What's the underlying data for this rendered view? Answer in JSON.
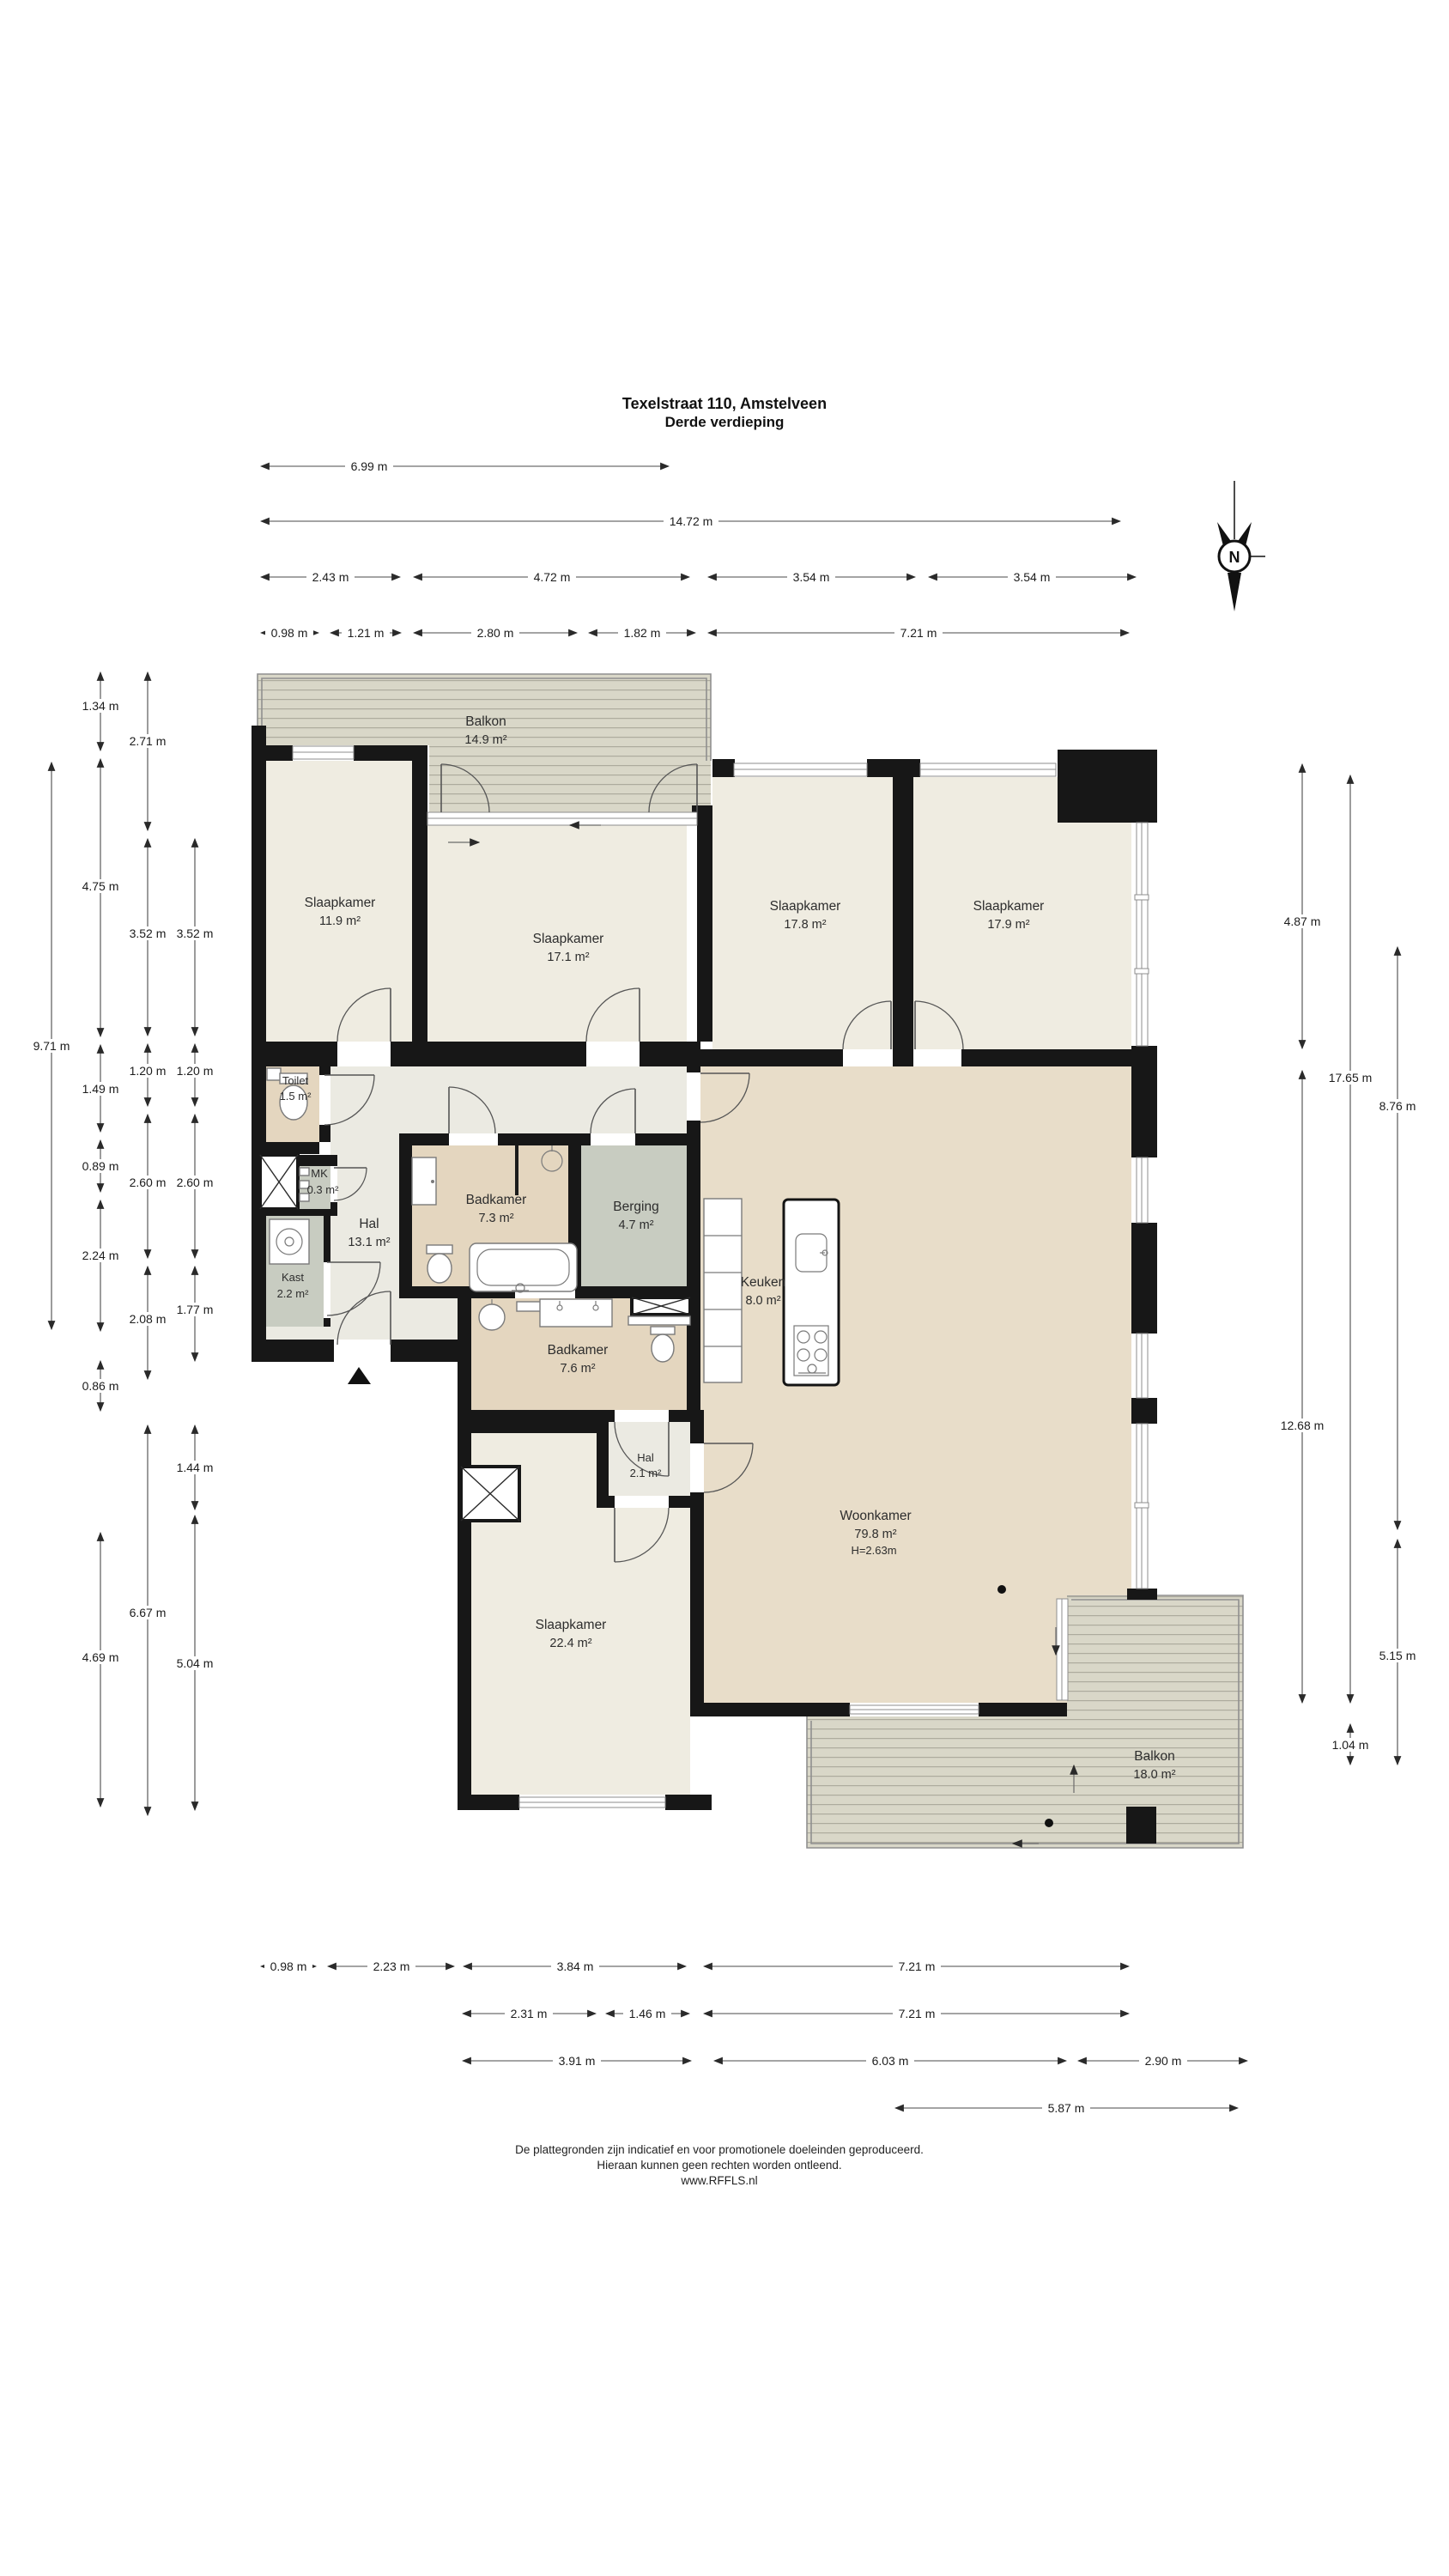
{
  "header": {
    "line1": "Texelstraat 110, Amstelveen",
    "line2": "Derde verdieping"
  },
  "compass": {
    "label": "N"
  },
  "rooms": {
    "balkon_top": {
      "name": "Balkon",
      "area": "14.9 m²"
    },
    "sk1": {
      "name": "Slaapkamer",
      "area": "11.9 m²"
    },
    "sk2": {
      "name": "Slaapkamer",
      "area": "17.1 m²"
    },
    "sk3": {
      "name": "Slaapkamer",
      "area": "17.8 m²"
    },
    "sk4": {
      "name": "Slaapkamer",
      "area": "17.9 m²"
    },
    "toilet": {
      "name": "Toilet",
      "area": "1.5 m²"
    },
    "mk": {
      "name": "MK",
      "area": "0.3 m²"
    },
    "hal": {
      "name": "Hal",
      "area": "13.1 m²"
    },
    "kast": {
      "name": "Kast",
      "area": "2.2 m²"
    },
    "badkamer1": {
      "name": "Badkamer",
      "area": "7.3 m²"
    },
    "berging": {
      "name": "Berging",
      "area": "4.7 m²"
    },
    "badkamer2": {
      "name": "Badkamer",
      "area": "7.6 m²"
    },
    "keuken": {
      "name": "Keuken",
      "area": "8.0 m²"
    },
    "woonkamer": {
      "name": "Woonkamer",
      "area": "79.8 m²",
      "height": "H=2.63m"
    },
    "hal2": {
      "name": "Hal",
      "area": "2.1 m²"
    },
    "sk5": {
      "name": "Slaapkamer",
      "area": "22.4 m²"
    },
    "balkon_bottom": {
      "name": "Balkon",
      "area": "18.0 m²"
    }
  },
  "dims": {
    "top": [
      [
        "6.99 m"
      ],
      [
        "14.72 m"
      ],
      [
        "2.43 m",
        "4.72 m",
        "3.54 m",
        "3.54 m"
      ],
      [
        "0.98 m",
        "1.21 m",
        "2.80 m",
        "1.82 m",
        "7.21 m"
      ]
    ],
    "left": [
      [
        "9.71 m"
      ],
      [
        "1.34 m",
        "4.75 m",
        "1.49 m",
        "0.89 m",
        "2.24 m",
        "0.86 m",
        "4.69 m"
      ],
      [
        "2.71 m",
        "3.52 m",
        "1.20 m",
        "2.60 m",
        "2.08 m",
        "6.67 m"
      ],
      [
        "3.52 m",
        "1.20 m",
        "2.60 m",
        "1.77 m",
        "1.44 m",
        "5.04 m"
      ]
    ],
    "right": [
      [
        "4.87 m",
        "12.68 m"
      ],
      [
        "17.65 m",
        "1.04 m"
      ],
      [
        "8.76 m",
        "5.15 m"
      ]
    ],
    "bottom": [
      [
        "0.98 m",
        "2.23 m",
        "3.84 m",
        "7.21 m"
      ],
      [
        "2.31 m",
        "1.46 m",
        "7.21 m"
      ],
      [
        "3.91 m",
        "6.03 m",
        "2.90 m"
      ],
      [
        "5.87 m"
      ]
    ]
  },
  "footer": {
    "line1": "De plattegronden zijn indicatief en voor promotionele doeleinden geproduceerd.",
    "line2": "Hieraan kunnen geen rechten worden ontleend.",
    "line3": "www.RFFLS.nl"
  },
  "colors": {
    "wall": "#171717",
    "room_cream": "#efece1",
    "room_warm": "#e8ddc9",
    "room_tan": "#e4d6bf",
    "room_gray": "#c8ccc1",
    "hall_light": "#ebeae2",
    "deck": "#d9d7c8",
    "deck_stripe": "#adab9d"
  }
}
